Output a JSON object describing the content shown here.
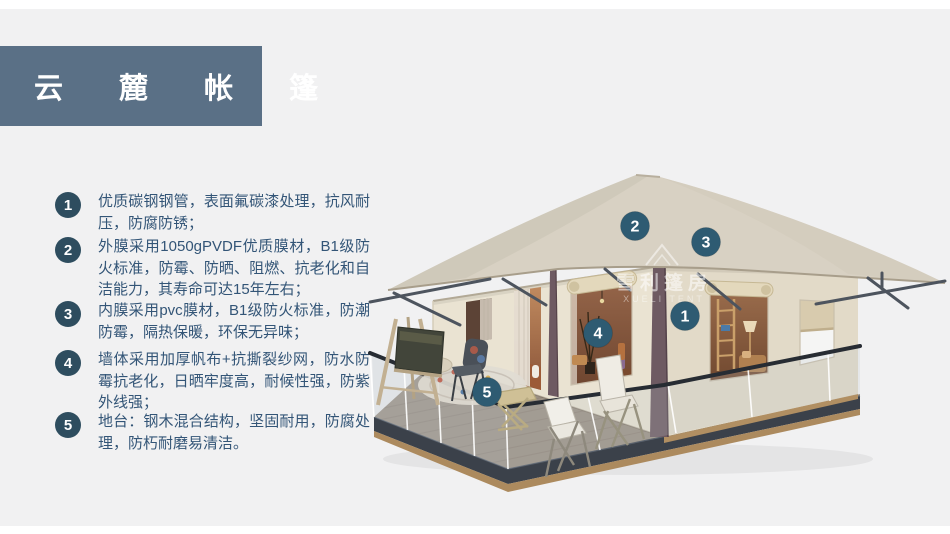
{
  "page": {
    "background_color": "#f1f1f2",
    "frame_color": "#ffffff"
  },
  "title": {
    "text": "云 麓 帐 篷",
    "bg_color": "#5a7086",
    "text_color": "#ffffff"
  },
  "features": {
    "badge_color": "#2e4d5f",
    "text_color": "#335577",
    "items": [
      {
        "num": "1",
        "text": "优质碳钢钢管，表面氟碳漆处理，抗风耐压，防腐防锈；"
      },
      {
        "num": "2",
        "text": "外膜采用1050gPVDF优质膜材，B1级防火标准，防霉、防晒、阻燃、抗老化和自洁能力，其寿命可达15年左右；"
      },
      {
        "num": "3",
        "text": "内膜采用pvc膜材，B1级防火标准，防潮防霉，隔热保暖，环保无异味；"
      },
      {
        "num": "4",
        "text": "墙体采用加厚帆布+抗撕裂纱网，防水防霉抗老化，日晒牢度高，耐候性强，防紫外线强；"
      },
      {
        "num": "5",
        "text": "地台：钢木混合结构，坚固耐用，防腐处理，防朽耐磨易清洁。"
      }
    ]
  },
  "tent": {
    "marker_color": "#2e5b72",
    "markers": [
      {
        "label": "1"
      },
      {
        "label": "2"
      },
      {
        "label": "3"
      },
      {
        "label": "4"
      },
      {
        "label": "5"
      }
    ],
    "watermark": {
      "line1": "雪利篷房",
      "line2": "XUELI TENT"
    }
  }
}
